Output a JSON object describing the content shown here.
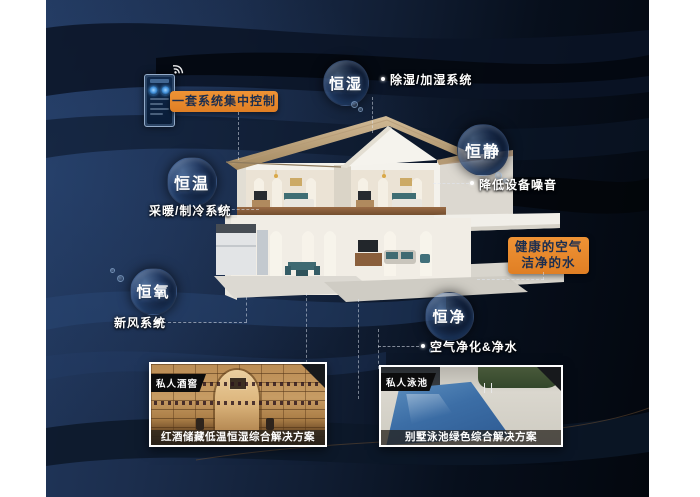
{
  "poster": {
    "bubbles": [
      {
        "label": "恒湿"
      },
      {
        "label": "恒静"
      },
      {
        "label": "恒温"
      },
      {
        "label": "恒氧"
      },
      {
        "label": "恒净"
      }
    ],
    "callouts": {
      "dehumidify": "除湿/加湿系统",
      "noise": "降低设备噪音",
      "hvac": "采暖/制冷系统",
      "fresh_air": "新风系统",
      "purify": "空气净化&净水"
    },
    "highlights": {
      "central_control": "一套系统集中控制",
      "healthy_air": "健康的空气",
      "clean_water": "洁净的水"
    },
    "cards": [
      {
        "badge": "私人酒窖",
        "caption": "红酒储藏低温恒湿综合解决方案"
      },
      {
        "badge": "私人泳池",
        "caption": "别墅泳池绿色综合解决方案"
      }
    ],
    "colors": {
      "accent": "#e5872c",
      "background": "#15253f",
      "text": "#ffffff"
    }
  }
}
